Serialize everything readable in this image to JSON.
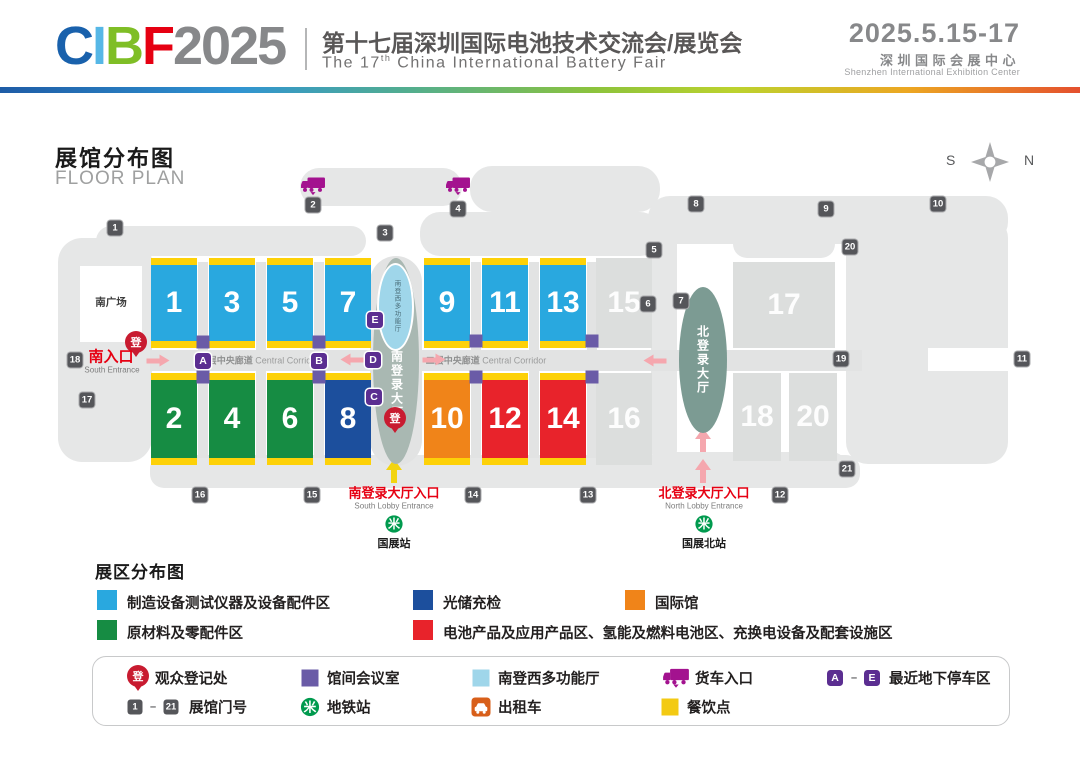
{
  "header": {
    "logo_letters": [
      {
        "char": "C",
        "color": "#1961ac"
      },
      {
        "char": "I",
        "color": "#56b7e6"
      },
      {
        "char": "B",
        "color": "#7fbe26"
      },
      {
        "char": "F",
        "color": "#e60012"
      }
    ],
    "logo_year": "2025",
    "logo_year_color": "#87888a",
    "title_zh": "第十七届深圳国际电池技术交流会/展览会",
    "title_en_prefix": "The 17",
    "title_en_sup": "th",
    "title_en_rest": " China International Battery Fair",
    "dates": "2025.5.15-17",
    "venue_zh": "深圳国际会展中心",
    "venue_en": "Shenzhen International Exhibition Center"
  },
  "floor_plan": {
    "title_zh": "展馆分布图",
    "title_en": "FLOOR PLAN",
    "compass": {
      "left": "S",
      "right": "N"
    },
    "plaza_label": "南广场",
    "corridor_label_zh": "二层中央廊道",
    "corridor_label_en": "Central Corridor",
    "south_lobby_label": "南登录大厅",
    "south_lobby_hall_label": "南登西多功能厅",
    "north_lobby_label": "北登录大厅",
    "register_glyph": "登",
    "entrances": {
      "south_zh": "南入口",
      "south_en": "South Entrance",
      "south_lobby_zh": "南登录大厅入口",
      "south_lobby_en": "South Lobby Entrance",
      "north_lobby_zh": "北登录大厅入口",
      "north_lobby_en": "North Lobby Entrance"
    },
    "metro_stations": [
      {
        "name": "国展站"
      },
      {
        "name": "国展北站"
      }
    ],
    "halls": [
      {
        "no": "1",
        "zone": "equipment"
      },
      {
        "no": "3",
        "zone": "equipment"
      },
      {
        "no": "5",
        "zone": "equipment"
      },
      {
        "no": "7",
        "zone": "equipment"
      },
      {
        "no": "9",
        "zone": "equipment"
      },
      {
        "no": "11",
        "zone": "equipment"
      },
      {
        "no": "13",
        "zone": "equipment"
      },
      {
        "no": "15",
        "zone": "general"
      },
      {
        "no": "2",
        "zone": "materials"
      },
      {
        "no": "4",
        "zone": "materials"
      },
      {
        "no": "6",
        "zone": "materials"
      },
      {
        "no": "8",
        "zone": "storage"
      },
      {
        "no": "10",
        "zone": "international"
      },
      {
        "no": "12",
        "zone": "battery"
      },
      {
        "no": "14",
        "zone": "battery"
      },
      {
        "no": "16",
        "zone": "general"
      },
      {
        "no": "17",
        "zone": "general"
      },
      {
        "no": "18",
        "zone": "general"
      },
      {
        "no": "20",
        "zone": "general"
      }
    ],
    "gates": [
      "1",
      "2",
      "3",
      "4",
      "5",
      "6",
      "7",
      "8",
      "9",
      "10",
      "11",
      "12",
      "13",
      "14",
      "15",
      "16",
      "17",
      "18",
      "19",
      "20",
      "21"
    ],
    "parking_badges": [
      "A",
      "B",
      "C",
      "D",
      "E"
    ]
  },
  "zones": {
    "equipment": {
      "color": "#29a8df",
      "label": "制造设备测试仪器及设备配件区"
    },
    "materials": {
      "color": "#168c43",
      "label": "原材料及零配件区"
    },
    "storage": {
      "color": "#1c4f9d",
      "label": "光储充检"
    },
    "international": {
      "color": "#f08419",
      "label": "国际馆"
    },
    "battery": {
      "color": "#e8232b",
      "label": "电池产品及应用产品区、氢能及燃料电池区、充换电设备及配套设施区"
    },
    "general": {
      "color": "#dcdedd",
      "label": ""
    }
  },
  "zone_legend_title": "展区分布图",
  "facility_legend": {
    "row1": [
      {
        "icon": "register-pin",
        "label": "观众登记处"
      },
      {
        "icon": "meeting-square",
        "label": "馆间会议室"
      },
      {
        "icon": "multihall-square",
        "label": "南登西多功能厅"
      },
      {
        "icon": "truck",
        "label": "货车入口"
      },
      {
        "icon": "parking-range",
        "from": "A",
        "dash": "–",
        "to": "E",
        "label": "最近地下停车区"
      }
    ],
    "row2": [
      {
        "icon": "gate-range",
        "from": "1",
        "dash": "–",
        "to": "21",
        "label": "展馆门号"
      },
      {
        "icon": "metro",
        "label": "地铁站"
      },
      {
        "icon": "taxi",
        "label": "出租车"
      },
      {
        "icon": "dining-square",
        "label": "餐饮点"
      }
    ]
  },
  "colors": {
    "yellow_strip": "#fdd108",
    "meeting_purple": "#6a5ba7",
    "parking_purple": "#5b2e91",
    "multihall_blue": "#9fd6ea",
    "dining_yellow": "#f3ca13",
    "truck_magenta": "#a3128f",
    "metro_green": "#009a4e",
    "taxi_orange": "#d85f1a",
    "gate_gray": "#55565a",
    "register_red": "#c81b30",
    "arrow_pink": "#f5a7ae",
    "arrow_yellow": "#f2d411",
    "south_lobby_fill": "#a9b8b2",
    "north_lobby_fill": "#7c9b93"
  }
}
